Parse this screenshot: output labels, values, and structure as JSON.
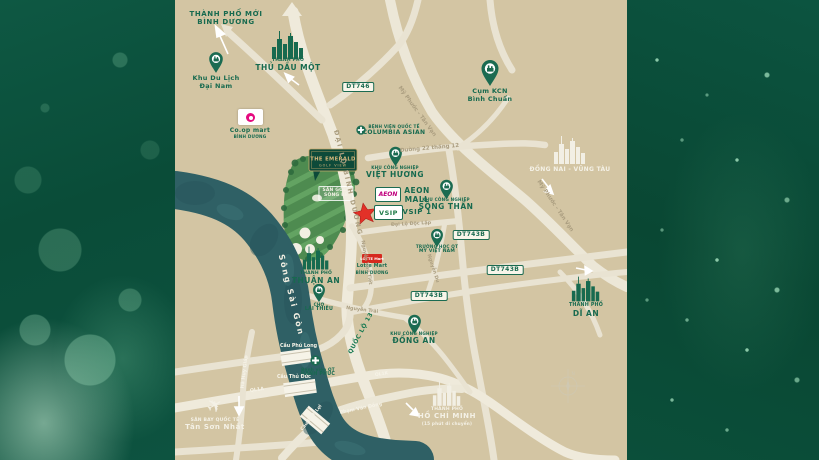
{
  "colors": {
    "brand_green": "#176a4f",
    "panel_green": "#0a4c38",
    "map_tan": "#d3c5a3",
    "road_light": "#ece7d7",
    "river_teal": "#2f6065",
    "golf_green": "#4e8b50",
    "star_red": "#e23128",
    "aeon_magenta": "#c0007e",
    "lotte_red": "#d6281e",
    "coop_pink": "#e5097f",
    "logo_gold": "#d8b97c"
  },
  "project": {
    "name_line1": "THE EMERALD",
    "name_line2": "GOLF VIEW"
  },
  "compass": {
    "north_label": "N"
  },
  "river": {
    "label": "Sông Sài Gòn"
  },
  "cities": {
    "binh_duong_new_city": {
      "line1": "THÀNH PHỐ MỚI",
      "line2": "BÌNH DƯƠNG"
    },
    "thu_dau_mot": {
      "line1": "THÀNH PHỐ",
      "line2": "THỦ DẦU MỘT"
    },
    "thuan_an": {
      "line1": "THÀNH PHỐ",
      "line2": "THUẬN AN"
    },
    "di_an": {
      "line1": "THÀNH PHỐ",
      "line2": "DĨ AN"
    },
    "ho_chi_minh": {
      "line1": "THÀNH PHỐ",
      "line2": "HỒ CHÍ MINH",
      "line3": "(15 phút di chuyển)"
    },
    "dong_nai_vung_tau": {
      "label": "ĐỒNG NAI - VŨNG TÀU"
    }
  },
  "pois": {
    "dai_nam": {
      "line1": "Khu Du Lịch",
      "line2": "Đại Nam"
    },
    "coop_mart": {
      "line1": "Co.op mart",
      "line2": "BÌNH DƯƠNG"
    },
    "kcn_binh_chuan": {
      "line1": "Cụm KCN",
      "line2": "Bình Chuẩn"
    },
    "columbia_asian": {
      "line1": "BỆNH VIỆN QUỐC TẾ",
      "line2": "COLUMBIA ASIAN"
    },
    "kcn_viet_huong": {
      "line1": "KHU CÔNG NGHIỆP",
      "line2": "VIỆT HƯƠNG"
    },
    "kcn_song_than": {
      "line1": "KHU CÔNG NGHIỆP",
      "line2": "SÔNG THẦN"
    },
    "kcn_dong_an": {
      "line1": "KHU CÔNG NGHIỆP",
      "line2": "ĐỒNG AN"
    },
    "aeon_mall": {
      "logo_text": "AEON",
      "line1": "AEON",
      "line2": "MALL"
    },
    "vsip": {
      "logo_text": "VSIP",
      "label": "VSIP 1"
    },
    "intl_school": {
      "line1": "TRƯỜNG HỌC QT",
      "line2": "MỸ VIỆT NAM"
    },
    "lotte_mart": {
      "logo_text": "LOTTE Mart",
      "line1": "Lotte Mart",
      "line2": "BÌNH DƯƠNG"
    },
    "cho_lai_thieu": {
      "line1": "CHỢ",
      "line2": "LÁI THIÊU"
    },
    "hanh_phuc_hospital": {
      "line1": "Bệnh viện QT",
      "line2": "HẠNH PHÚC"
    },
    "san_golf": {
      "line1": "SÂN GOLF",
      "line2": "SÔNG BÉ"
    },
    "tan_son_nhat": {
      "line1": "SÂN BAY QUỐC TẾ",
      "line2": "Tân Sơn Nhất"
    }
  },
  "roads": {
    "dai_lo_binh_duong": "ĐẠI LỘ BÌNH DƯƠNG",
    "my_phuoc_tan_van": "Mỹ Phước - Tân Vạn",
    "duong_22_thang_12": "Đường 22 tháng 12",
    "dai_lo_doc_lap": "Đại Lộ Độc Lập",
    "nguyen_van_tiet": "Nguyễn Văn Tiết",
    "nguyen_trai": "Nguyễn Trãi",
    "nguyen_du": "Nguyễn Du",
    "quoc_lo_13": "QUỐC LỘ 13",
    "ha_huy_giap": "Hà Huy Giáp",
    "ql1a": "QL1A",
    "ql1k": "QL1K",
    "pham_van_dong": "Phạm Văn Đồng",
    "badge_dt746": "DT746",
    "badge_dt743b": "DT743B"
  },
  "bridges": {
    "cau_phu_long": "Cầu Phú Long",
    "cau_thu_duc": "Cầu Thủ Đức",
    "cau_binh_loi": "Cầu Bình Lợi"
  }
}
